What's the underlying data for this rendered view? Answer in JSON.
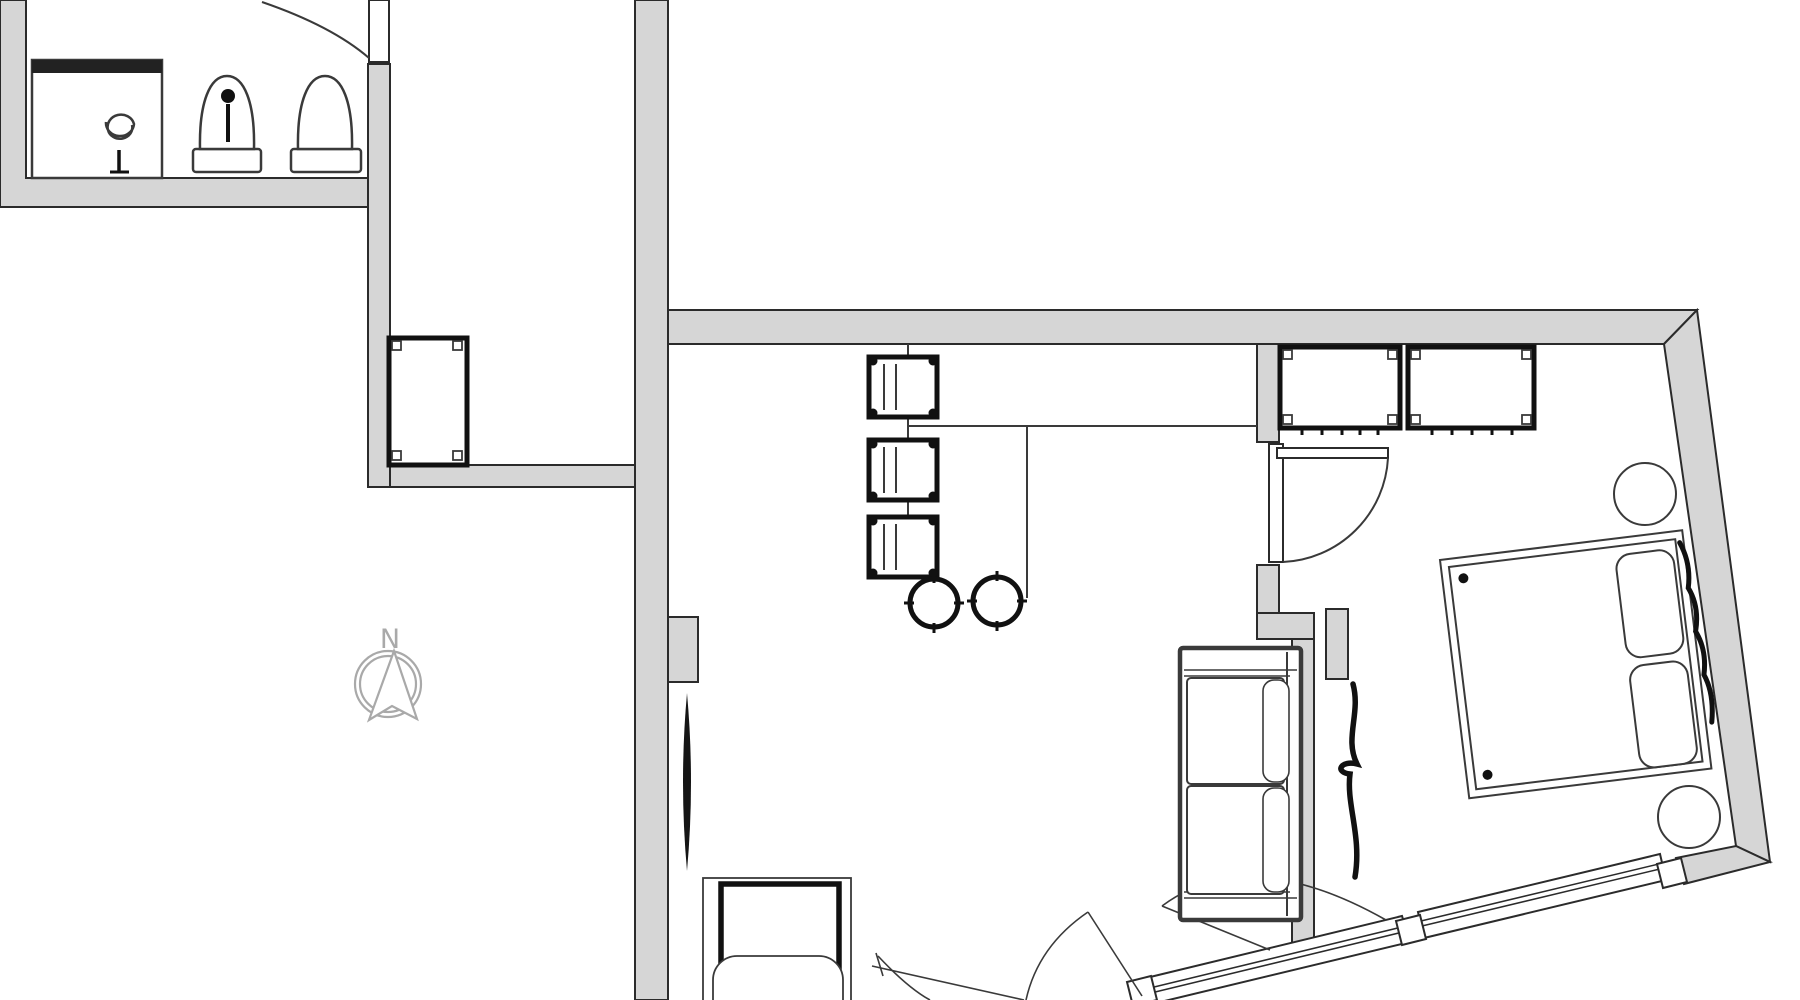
{
  "drawing": {
    "kind": "architectural-floor-plan",
    "has_text_labels": false
  },
  "compass": {
    "label": "N"
  },
  "colors": {
    "background": "#ffffff",
    "wall_fill": "#d6d6d6",
    "wall_outline": "#2b2b2b",
    "thin_line": "#3a3a3a",
    "bold_line": "#111111",
    "compass": "#a9a9a9"
  },
  "inventory": {
    "bar_chairs": 3,
    "bar_stools": 2,
    "wardrobes": 2,
    "bed_pillows": 2,
    "round_side_tables": 2,
    "sofas": 1,
    "armchairs": 1,
    "bathroom_fixtures": 3,
    "door_swings": 5,
    "window_segments": 2
  }
}
